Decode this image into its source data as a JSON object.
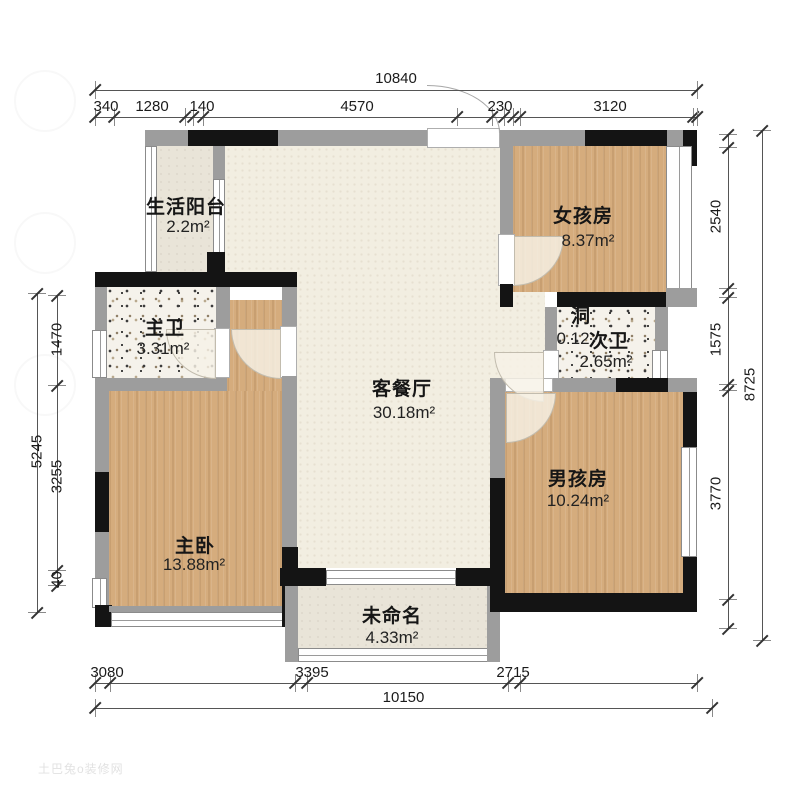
{
  "watermark": {
    "text": "土巴兔o装修网"
  },
  "rooms": [
    {
      "id": "balcony",
      "name": "生活阳台",
      "area": "2.2m²"
    },
    {
      "id": "girl-room",
      "name": "女孩房",
      "area": "8.37m²"
    },
    {
      "id": "master-bath",
      "name": "主卫",
      "area": "3.31m²"
    },
    {
      "id": "shaft",
      "name": "洞",
      "area": "0.12"
    },
    {
      "id": "second-bath",
      "name": "次卫",
      "area": "2.65m²"
    },
    {
      "id": "living",
      "name": "客餐厅",
      "area": "30.18m²"
    },
    {
      "id": "boy-room",
      "name": "男孩房",
      "area": "10.24m²"
    },
    {
      "id": "master-bed",
      "name": "主卧",
      "area": "13.88m²"
    },
    {
      "id": "unnamed",
      "name": "未命名",
      "area": "4.33m²"
    }
  ],
  "dimensions": {
    "top": {
      "total": "10840",
      "segments": [
        "340",
        "1280",
        "140",
        "4570",
        "230",
        "3120"
      ]
    },
    "bottom": {
      "total": "10150",
      "segments": [
        "3080",
        "3395",
        "2715"
      ]
    },
    "left": {
      "total": "5245",
      "segments": [
        "1470",
        "3255",
        "40"
      ]
    },
    "right": {
      "total": "8725",
      "segments": [
        "2540",
        "1575",
        "3770"
      ]
    }
  },
  "colors": {
    "wall_gray": "#9d9d9d",
    "wall_black": "#141414",
    "wood_floor": "#d5ac7d",
    "living_floor": "#f2eee1",
    "bath_floor": "#f5f2eb"
  }
}
